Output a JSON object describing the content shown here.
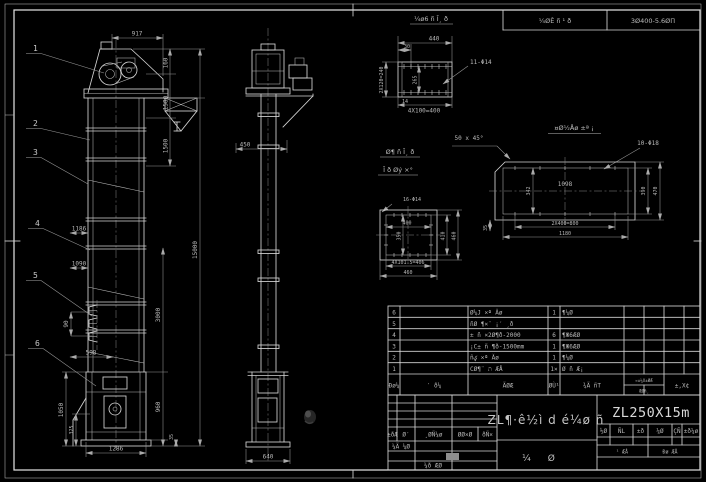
{
  "colors": {
    "background": "#000000",
    "line": "#d4d4d4",
    "dim_line": "#989898",
    "text": "#b8b8b8"
  },
  "top_strip": {
    "left_cell": "¼ØÊ ñ ¹ ð",
    "right_cell": "3Ø400-5.6ØΠ"
  },
  "front_view": {
    "balloons": [
      "1",
      "2",
      "3",
      "4",
      "5",
      "6"
    ],
    "dim_width_top": "917",
    "dim_h1": "160",
    "dim_h2": "1580",
    "dim_h3": "1500",
    "dim_total": "15000",
    "dim_mid1": "1186",
    "dim_mid2": "1090",
    "dim_bucket": "90",
    "dim_inlet": "598",
    "dim_boot_h": "1050",
    "dim_boot_inner": "325",
    "dim_base_w": "1286",
    "dim_r1": "3000",
    "dim_r2": "960",
    "dim_r3": "35"
  },
  "side_view": {
    "dim_w": "450",
    "dim_base": "640"
  },
  "channel_detail": {
    "label": "¼ø6 ñ Ī¸ ð",
    "dim_w": "440",
    "dim_offset": "30",
    "holes": "11-Φ14",
    "dim_left": "2X120=240",
    "dim_inner": "265",
    "dim_bottom": "4X100=400",
    "note": "14"
  },
  "flange_detail": {
    "label_line1": "Ø¶ ñ Ī¸ ð",
    "label_line2": "Ī ð Øý ×°",
    "holes": "16-Φ14",
    "dim_inner_w": "400",
    "dim_inner_h": "350",
    "dim_r1": "410",
    "dim_r2": "460",
    "dim_b1": "4X101.5=406",
    "dim_b2": "460"
  },
  "plate_detail": {
    "label": "¤Ø½Åø ±ª ¡",
    "chamfer": "50 x 45°",
    "holes": "10-Φ18",
    "dim_inner": "1098",
    "dim_left": "342",
    "dim_r1": "390",
    "dim_r2": "470",
    "dim_b1": "2X400=800",
    "dim_b2": "1180",
    "dim_side": "35"
  },
  "parts_table": {
    "headers": {
      "no": "Ðø¼",
      "code": "′ ð¼",
      "name": "ÃØÆ",
      "qty": "ØÙ¹",
      "material": "¾Ã ñT",
      "weight": "¤±¼X±ØÆ",
      "weight_sub": "ÆØñ¸",
      "note": "±,X¢"
    },
    "rows": [
      {
        "no": "6",
        "desc": "Ø¼J ×ª Ăø",
        "qty": "1",
        "mat": "¶¼Ø"
      },
      {
        "no": "5",
        "desc": "ñØ ¶×¨ ¡′ ¸ð",
        "qty": "",
        "mat": ""
      },
      {
        "no": "4",
        "desc": "± ñ ×2Ø¶ð-2000",
        "qty": "6",
        "mat": "¶Ж6ÆØ"
      },
      {
        "no": "3",
        "desc": "¡C± ñ ¶ð-1500mm",
        "qty": "1",
        "mat": "¶Ж6ÆØ"
      },
      {
        "no": "2",
        "desc": "ñؼ ×ª Ăø",
        "qty": "1",
        "mat": "¶¼Ø"
      },
      {
        "no": "1",
        "desc": "CØ¶¨ ת ÆÅ",
        "qty": "1×",
        "mat": "Ø ñ Æ¡"
      }
    ]
  },
  "title_block": {
    "rev_headers": [
      "±ðǼ",
      "Ø′",
      "¸ØÑ¼ø",
      "ØØ×Ø",
      "ðÑ×"
    ],
    "row_design": "¼Ã ¼Ø",
    "row_check": "¼ð ÆØ",
    "title": "ZL¶·ê½ì d é¼ø ñ",
    "subtitle": "¼ Ø",
    "model": "ZL250X15m",
    "stage_cells": [
      "½Ø",
      "ÑL",
      "±ð",
      "¼Ø",
      "ÇÑ",
      "±ð¼ø"
    ],
    "sheet_left": "¹ ÆÅ",
    "sheet_right": "Ðø ÆÅ"
  }
}
